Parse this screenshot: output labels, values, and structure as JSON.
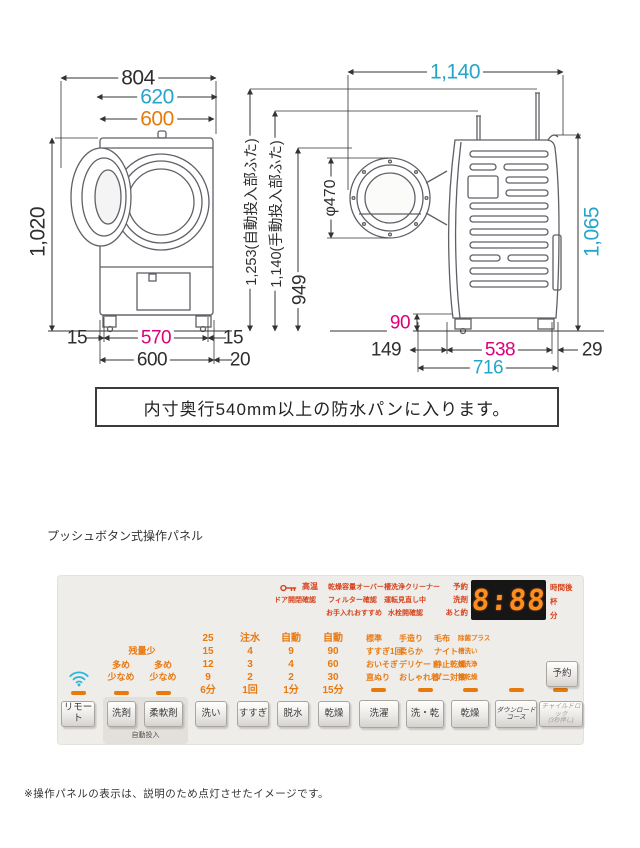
{
  "colors": {
    "cyan": "#25a5c9",
    "orange": "#e87a0c",
    "magenta": "#dc0078",
    "ink": "#2e2e2e",
    "panel_orange": "#e87911",
    "panel_red": "#d6421a",
    "dash": "#e87a0c",
    "display_digit": "#ff8d1f",
    "display_bg": "#161616"
  },
  "diagram": {
    "front": {
      "w804": "804",
      "w620": "620",
      "w600": "600",
      "h1020": "1,020",
      "b15l": "15",
      "b570": "570",
      "b15r": "15",
      "b600": "600",
      "b20": "20"
    },
    "mid": {
      "h1253": "1,253(自動投入部ふた)",
      "h1140": "1,140(手動投入部ふた)",
      "h949": "949"
    },
    "side": {
      "w1140": "1,140",
      "phi470": "φ470",
      "h1065": "1,065",
      "h90": "90",
      "d149": "149",
      "d538": "538",
      "d29": "29",
      "d716": "716"
    },
    "note": "内寸奥行540mm以上の防水パンに入ります。"
  },
  "section": {
    "panel_title": "プッシュボタン式操作パネル",
    "footnote": "※操作パネルの表示は、説明のため点灯させたイメージです。"
  },
  "panel": {
    "indicators": {
      "high_temp": "高温",
      "dry_capacity_over": "乾燥容量オーバー",
      "tub_clean_cleaner": "槽洗浄クリーナー",
      "door_check": "ドア開閉確認",
      "filter_check": "フィルター確認",
      "operation_review": "運転見直し中",
      "maintenance": "お手入れおすすめ",
      "tap_open_check": "水栓開確認",
      "reserve": "予約",
      "detergent": "洗剤",
      "remaining": "あと約"
    },
    "display": {
      "value": "8:88",
      "unit_hours": "時間後",
      "unit_cups": "杯",
      "unit_minutes": "分"
    },
    "dispense": {
      "low_remaining": "残量少",
      "more_1": "多め",
      "less_1": "少なめ",
      "more_2": "多め",
      "less_2": "少なめ",
      "auto_label": "自動投入"
    },
    "steps": {
      "wash": [
        "25",
        "15",
        "12",
        "9",
        "6分"
      ],
      "rinse": [
        "注水",
        "4",
        "3",
        "2",
        "1回"
      ],
      "spin": [
        "自動",
        "9",
        "4",
        "2",
        "1分"
      ],
      "dry": [
        "自動",
        "90",
        "60",
        "30",
        "15分"
      ]
    },
    "courses": {
      "laundry": [
        "標準",
        "すすぎ1回",
        "おいそぎ",
        "直ぬり"
      ],
      "washdry": [
        "手造り",
        "柔らか",
        "デリケート",
        "おしゃれ着"
      ],
      "dry": [
        "毛布",
        "ナイト",
        "静止乾燥",
        "ダニ対策"
      ],
      "download": [
        "除菌プラス",
        "槽洗い",
        "槽洗浄",
        "槽乾燥"
      ]
    },
    "buttons": {
      "remote": "リモート",
      "detergent": "洗剤",
      "softener": "柔軟剤",
      "wash": "洗い",
      "rinse": "すすぎ",
      "spin": "脱水",
      "dry": "乾燥",
      "laundry": "洗濯",
      "wash_dry": "洗・乾",
      "dry2": "乾燥",
      "download_line1": "ダウンロード",
      "download_line2": "コース",
      "childlock_line1": "チャイルドロック",
      "childlock_line2": "(3秒押し)",
      "reserve": "予約"
    }
  }
}
